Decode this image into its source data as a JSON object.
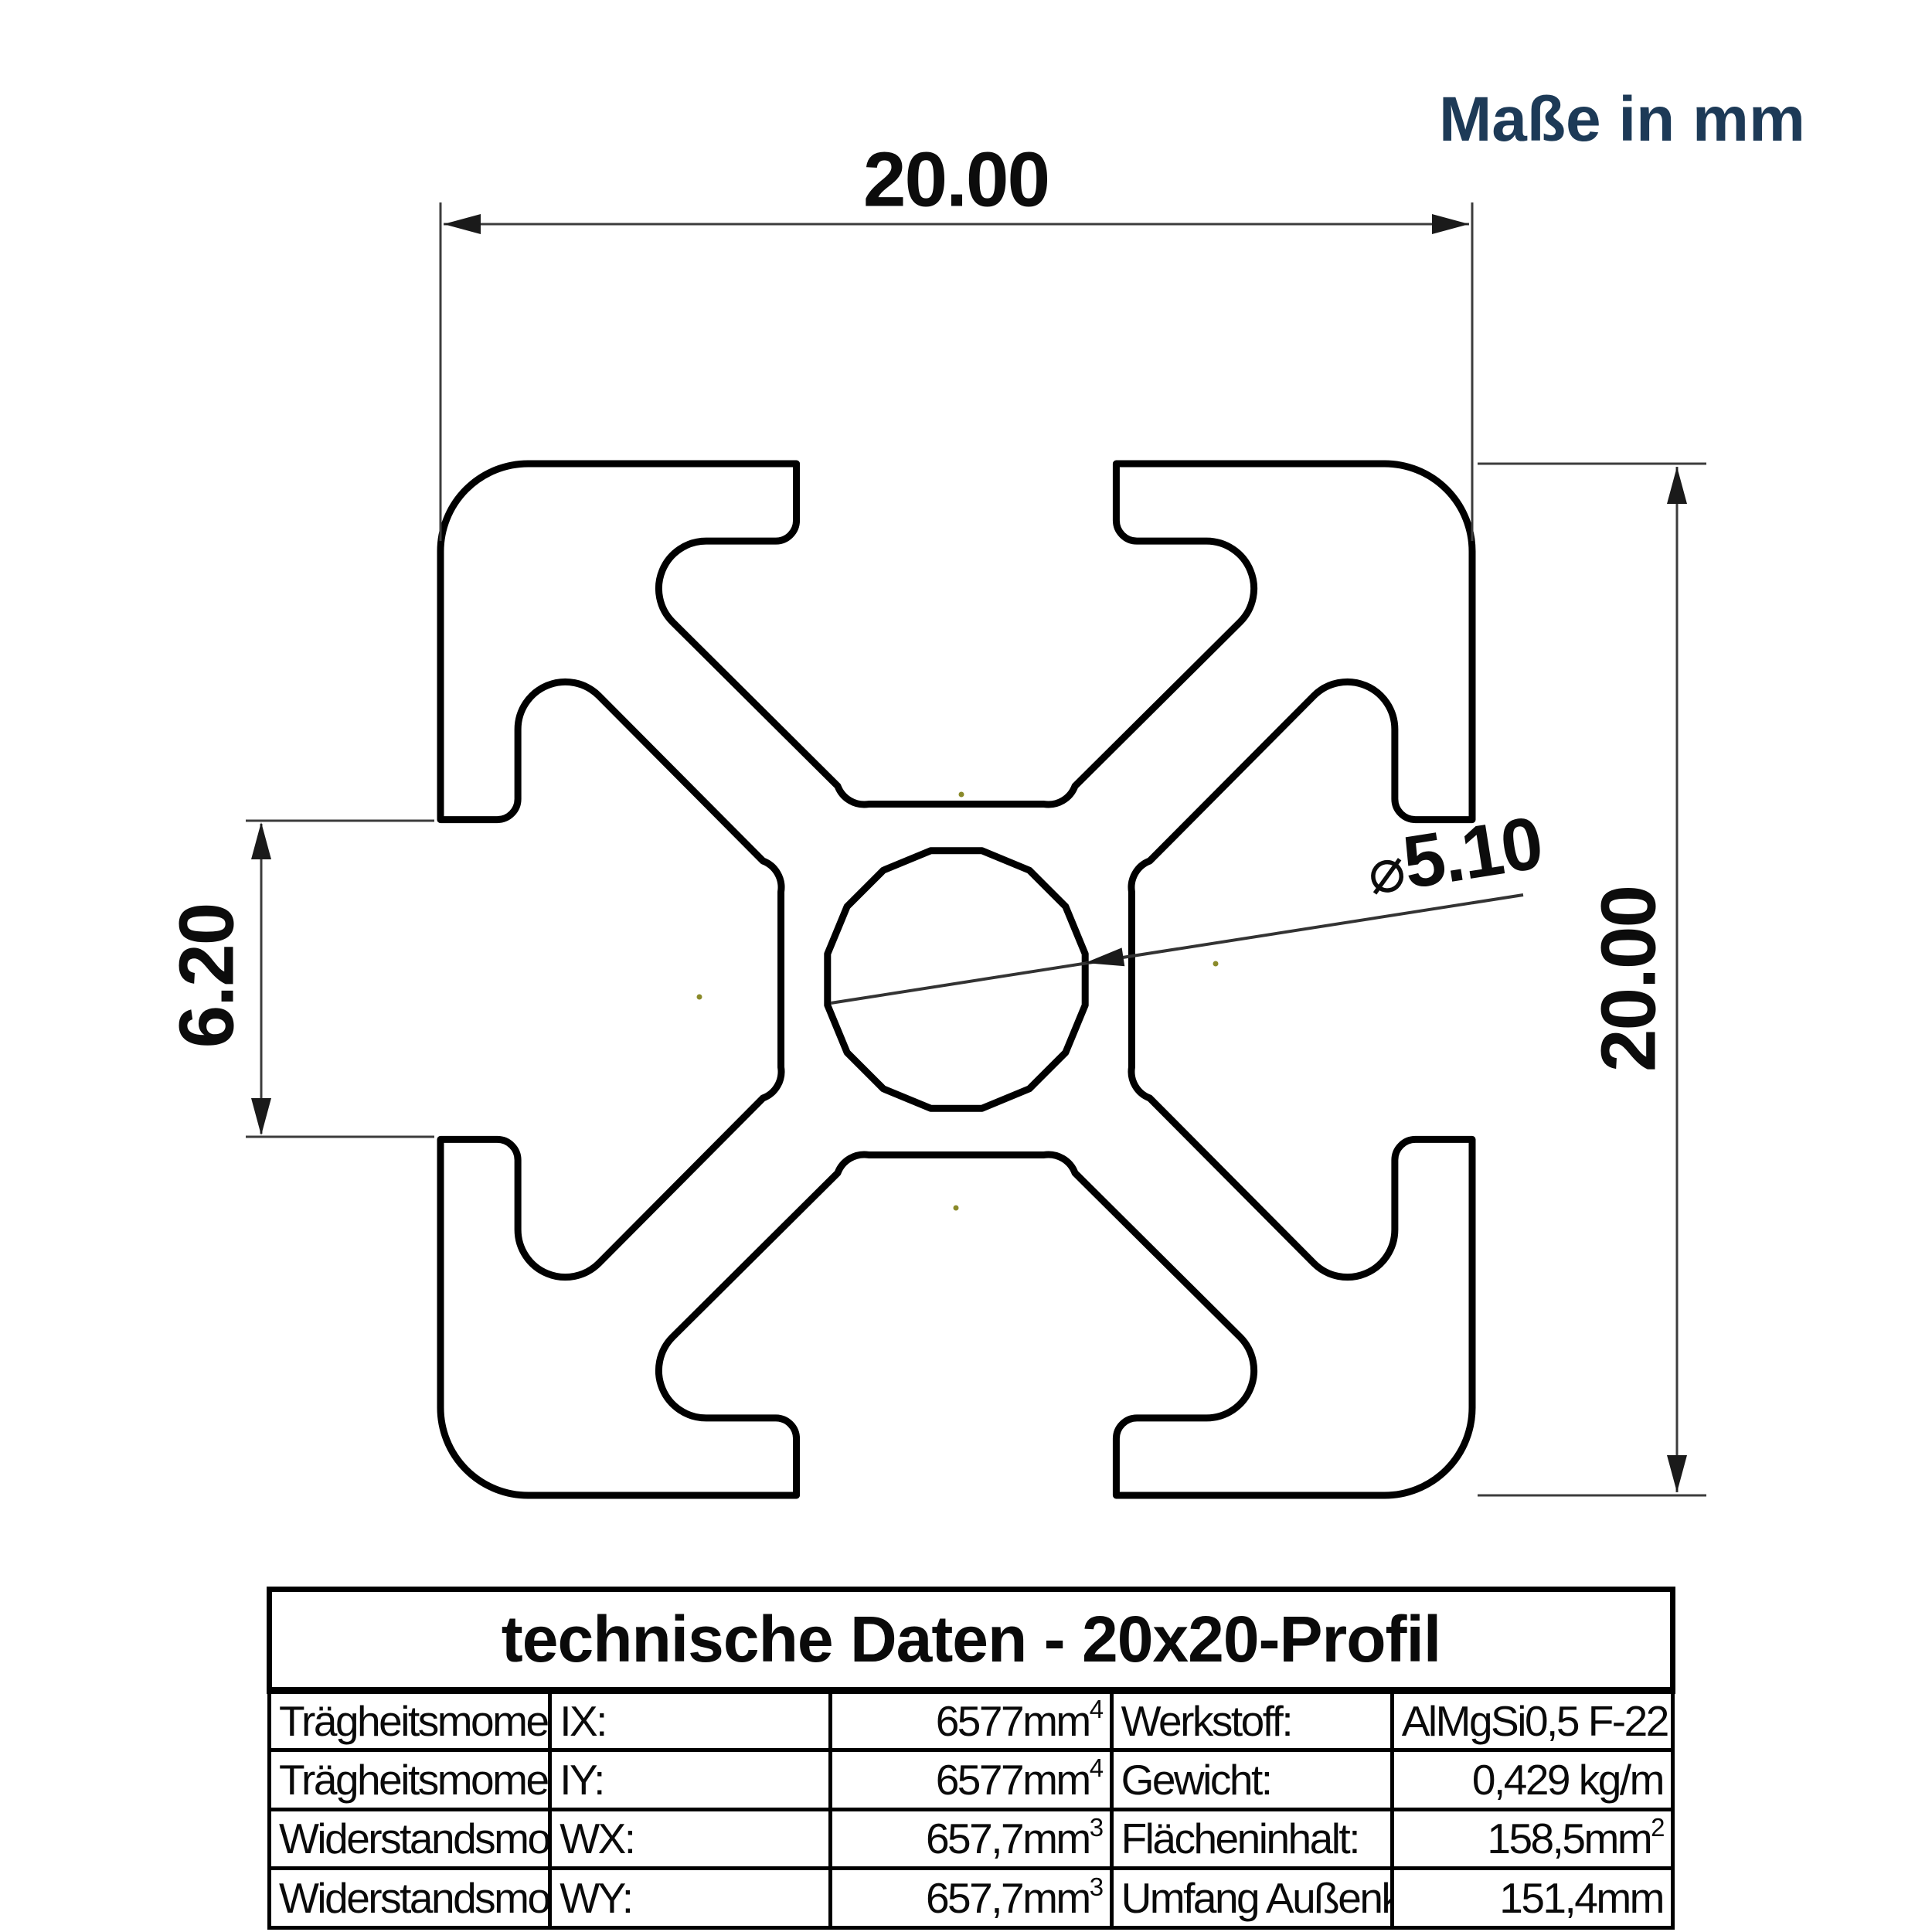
{
  "note": {
    "units_label": "Maße in mm",
    "color": "#1d3a57"
  },
  "dimensions": {
    "diameter_symbol": "⌀",
    "outer_width_mm": "20.00",
    "outer_height_mm": "20.00",
    "slot_opening_mm": "6.20",
    "bore_diameter_mm": "5.10"
  },
  "drawing": {
    "type": "cross-section of 20x20 aluminium T-slot extrusion profile",
    "line_color": "#000000",
    "dimension_line_color": "#3c3c3c",
    "vertex_dot_color": "#8a8a2a"
  },
  "table": {
    "title": "technische Daten - 20x20-Profil",
    "rows": [
      {
        "property": "Trägheitsmoment",
        "symbol": "IX:",
        "value_base": "6577mm",
        "value_sup": "4",
        "property2": "Werkstoff:",
        "value2_base": "AlMgSi0,5 F-22",
        "value2_sup": ""
      },
      {
        "property": "Trägheitsmoment",
        "symbol": "IY:",
        "value_base": "6577mm",
        "value_sup": "4",
        "property2": "Gewicht:",
        "value2_base": "0,429 kg/m",
        "value2_sup": ""
      },
      {
        "property": "Widerstandsmoment",
        "symbol": "WX:",
        "value_base": "657,7mm",
        "value_sup": "3",
        "property2": "Flächeninhalt:",
        "value2_base": "158,5mm",
        "value2_sup": "2"
      },
      {
        "property": "Widerstandsmoment",
        "symbol": "WY:",
        "value_base": "657,7mm",
        "value_sup": "3",
        "property2": "Umfang Außenkontur:",
        "value2_base": "151,4mm",
        "value2_sup": ""
      }
    ]
  }
}
